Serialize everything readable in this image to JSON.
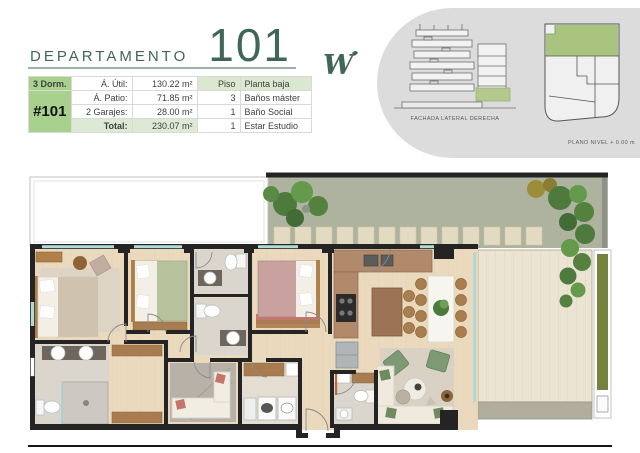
{
  "header": {
    "title_label": "DEPARTAMENTO",
    "unit_number": "101"
  },
  "logo": {
    "letter": "W"
  },
  "spec_table": {
    "unit_badge": "#101",
    "rows": [
      {
        "c1": "3 Dorm.",
        "c2": "Á. Útil:",
        "c3": "130.22 m²",
        "c4": "Piso",
        "c5": "Planta baja"
      },
      {
        "c1": "",
        "c2": "Á. Patio:",
        "c3": "71.85 m²",
        "c4": "3",
        "c5": "Baños máster"
      },
      {
        "c1": "#101",
        "c2": "2 Garajes:",
        "c3": "28.00 m²",
        "c4": "1",
        "c5": "Baño Social"
      },
      {
        "c1": "",
        "c2": "Total:",
        "c3": "230.07 m²",
        "c4": "1",
        "c5": "Estar Estudio"
      }
    ]
  },
  "panel": {
    "elevation_caption": "FACHADA LATERAL DERECHA",
    "siteplan_caption": "PLANO NIVEL + 0.00 m"
  },
  "colors": {
    "accent_green": "#a9d18e",
    "light_green_row": "#d9e8cf",
    "title_green": "#40655a",
    "panel_gray": "#dcdcdc",
    "siteplan_highlight": "#a9c47f",
    "wall_black": "#242424",
    "wood_floor": "#ead9bd",
    "garden_grass": "#adb39e",
    "deck_wood": "#ece4d2"
  }
}
